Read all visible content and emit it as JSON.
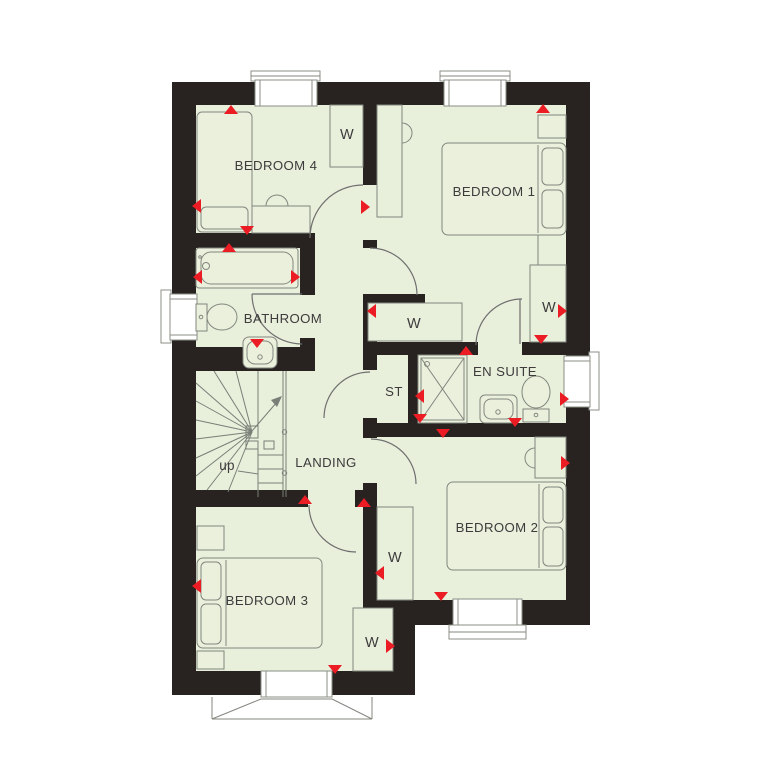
{
  "floorplan": {
    "rooms": {
      "bedroom1": "BEDROOM 1",
      "bedroom2": "BEDROOM 2",
      "bedroom3": "BEDROOM 3",
      "bedroom4": "BEDROOM 4",
      "bathroom": "BATHROOM",
      "ensuite": "EN SUITE",
      "store": "ST",
      "landing": "LANDING"
    },
    "labels": {
      "wardrobe": "W",
      "stairs_up": "up"
    },
    "colors": {
      "floor": "#e8efdb",
      "wall": "#282321",
      "marker": "#ec1c24",
      "furniture_outline": "#82877e",
      "text": "#3d3b3c",
      "window": "#ffffff"
    }
  }
}
